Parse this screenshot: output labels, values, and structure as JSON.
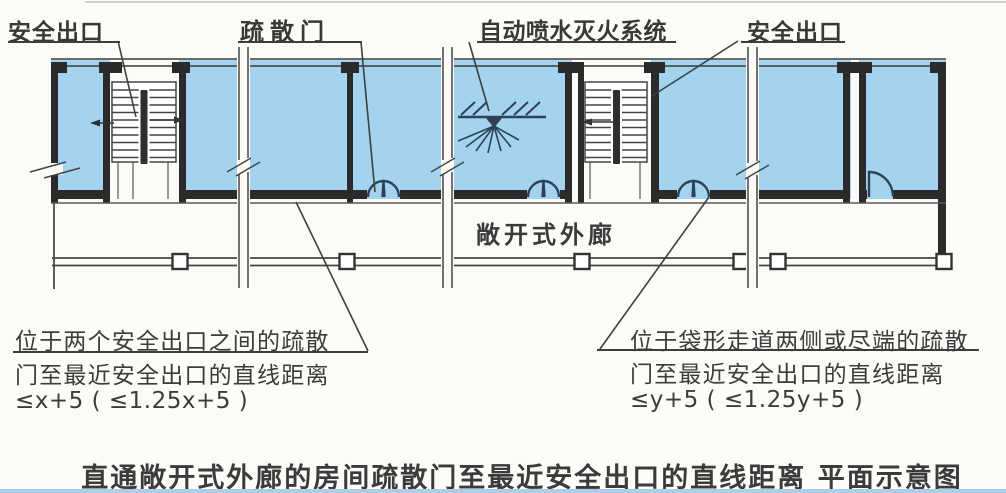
{
  "diagram": {
    "labels": {
      "exit_left": "安全出口",
      "evac_door": "疏散门",
      "sprinkler": "自动喷水灭火系统",
      "exit_right": "安全出口",
      "corridor": "敞开式外廊"
    },
    "notes": {
      "left": {
        "line1": "位于两个安全出口之间的疏散",
        "line2": "门至最近安全出口的直线距离",
        "formula": "≤x+5 ( ≤1.25x+5 )"
      },
      "right": {
        "line1": "位于袋形走道两侧或尽端的疏散",
        "line2": "门至最近安全出口的直线距离",
        "formula": "≤y+5 ( ≤1.25y+5 )"
      }
    },
    "caption": "直通敞开式外廊的房间疏散门至最近安全出口的直线距离 平面示意图",
    "colors": {
      "room_fill": "#a3d3ee",
      "wall": "#2b2b2b",
      "line": "#444444",
      "door": "#2e4156",
      "text": "#3a3a3a"
    }
  }
}
